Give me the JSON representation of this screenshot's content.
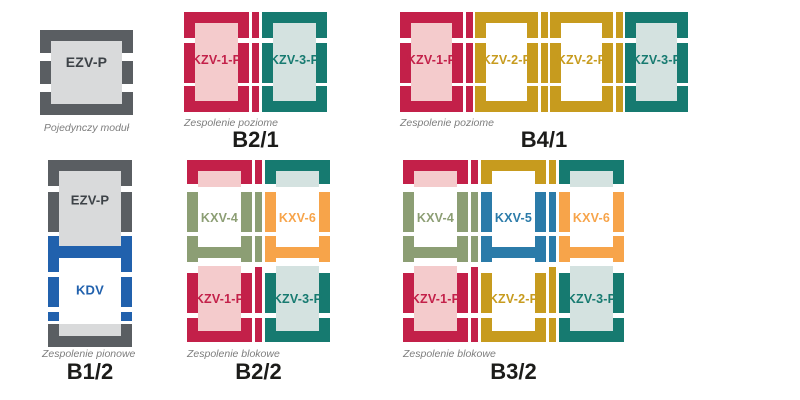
{
  "palette": {
    "background": "#ffffff",
    "caption_text": "#7d7d7d",
    "label_text": "#1c1c1a"
  },
  "codes": {
    "EZV-P": {
      "frame": "#5a5e62",
      "fill": "#d9dadb",
      "text": "#3d4247"
    },
    "KDV": {
      "frame": "#2161ad",
      "fill": "#ffffff",
      "text": "#2161ad"
    },
    "KZV-1-P": {
      "frame": "#c32049",
      "fill": "#f4cbcc",
      "text": "#c32049"
    },
    "KZV-2-P": {
      "frame": "#c79b1e",
      "fill": "#ffffff",
      "text": "#c79b1e"
    },
    "KZV-3-P": {
      "frame": "#167a70",
      "fill": "#d4e2e0",
      "text": "#167a70"
    },
    "KXV-4": {
      "frame": "#8c9e74",
      "fill": "#ffffff",
      "text": "#8c9e74"
    },
    "KXV-5": {
      "frame": "#2b7ba9",
      "fill": "#ffffff",
      "text": "#2b7ba9"
    },
    "KXV-6": {
      "frame": "#f7a44a",
      "fill": "#ffffff",
      "text": "#f7a44a"
    }
  },
  "diagrams": [
    {
      "id": "single",
      "caption": "Pojedynczy moduł",
      "label": "",
      "modules": [
        {
          "code": "EZV-P"
        }
      ]
    },
    {
      "id": "b21",
      "caption": "Zespolenie poziome",
      "label": "B2/1",
      "modules": [
        {
          "code": "KZV-1-P"
        },
        {
          "code": "KZV-3-P"
        }
      ]
    },
    {
      "id": "b41",
      "caption": "Zespolenie poziome",
      "label": "B4/1",
      "modules": [
        {
          "code": "KZV-1-P"
        },
        {
          "code": "KZV-2-P"
        },
        {
          "code": "KZV-2-P"
        },
        {
          "code": "KZV-3-P"
        }
      ]
    },
    {
      "id": "b12",
      "caption": "Zespolenie pionowe",
      "label": "B1/2",
      "modules": [
        {
          "code": "EZV-P"
        },
        {
          "code": "KDV"
        }
      ]
    },
    {
      "id": "b22",
      "caption": "Zespolenie blokowe",
      "label": "B2/2",
      "modules": [
        {
          "code": "KXV-4"
        },
        {
          "code": "KXV-6"
        },
        {
          "code": "KZV-1-P"
        },
        {
          "code": "KZV-3-P"
        }
      ]
    },
    {
      "id": "b32",
      "caption": "Zespolenie blokowe",
      "label": "B3/2",
      "modules": [
        {
          "code": "KXV-4"
        },
        {
          "code": "KXV-5"
        },
        {
          "code": "KXV-6"
        },
        {
          "code": "KZV-1-P"
        },
        {
          "code": "KZV-2-P"
        },
        {
          "code": "KZV-3-P"
        }
      ]
    }
  ]
}
